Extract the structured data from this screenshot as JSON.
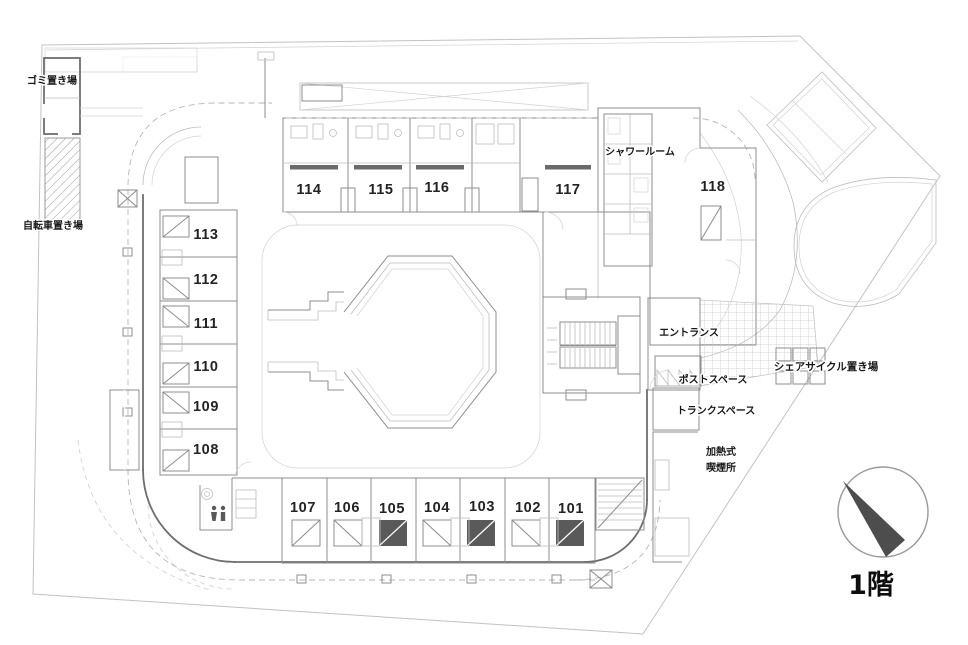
{
  "floor": {
    "label": "1階"
  },
  "labels": {
    "garbage_area": "ゴミ置き場",
    "bicycle_parking": "自転車置き場",
    "shower_room": "シャワールーム",
    "entrance": "エントランス",
    "post_space": "ポストスペース",
    "share_cycle_parking": "シェアサイクル置き場",
    "trunk_space": "トランクスペース",
    "smoking_area_line1": "加熱式",
    "smoking_area_line2": "喫煙所"
  },
  "rooms": [
    {
      "number": "101"
    },
    {
      "number": "102"
    },
    {
      "number": "103"
    },
    {
      "number": "104"
    },
    {
      "number": "105"
    },
    {
      "number": "106"
    },
    {
      "number": "107"
    },
    {
      "number": "108"
    },
    {
      "number": "109"
    },
    {
      "number": "110"
    },
    {
      "number": "111"
    },
    {
      "number": "112"
    },
    {
      "number": "113"
    },
    {
      "number": "114"
    },
    {
      "number": "115"
    },
    {
      "number": "116"
    },
    {
      "number": "117"
    },
    {
      "number": "118"
    }
  ],
  "colors": {
    "wall": "#6e6e6e",
    "light_line": "#bdbdbd",
    "text": "#1a1a1a",
    "compass_fill": "#4d4d4d",
    "background": "#ffffff"
  }
}
